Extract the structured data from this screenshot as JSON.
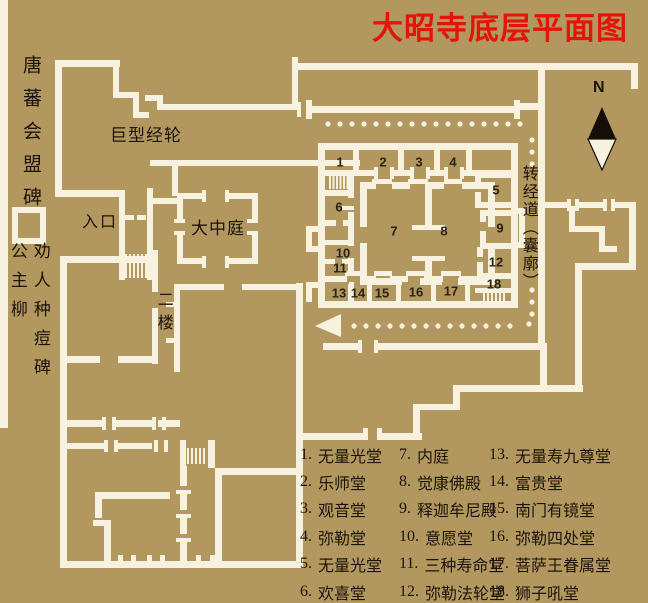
{
  "title": "大昭寺底层平面图",
  "map": {
    "labels": {
      "monument_tangbo": "唐蕃会盟碑",
      "princess_willow": "公主柳",
      "vaccination_monument": "劝人种痘碑",
      "giant_prayer_wheel": "巨型经轮",
      "entrance": "入口",
      "grand_courtyard": "大中庭",
      "second_floor": "二楼",
      "prayer_circuit": "转经道（囊廓）",
      "compass_north": "N"
    },
    "rooms": [
      {
        "id": "1",
        "name": "无量光堂"
      },
      {
        "id": "2",
        "name": "乐师堂"
      },
      {
        "id": "3",
        "name": "观音堂"
      },
      {
        "id": "4",
        "name": "弥勒堂"
      },
      {
        "id": "5",
        "name": "无量光堂"
      },
      {
        "id": "6",
        "name": "欢喜堂"
      },
      {
        "id": "7",
        "name": "内庭"
      },
      {
        "id": "8",
        "name": "觉康佛殿"
      },
      {
        "id": "9",
        "name": "释迦牟尼殿"
      },
      {
        "id": "10",
        "name": "意愿堂"
      },
      {
        "id": "11",
        "name": "三种寿命堂"
      },
      {
        "id": "12",
        "name": "弥勒法轮堂"
      },
      {
        "id": "13",
        "name": "无量寿九尊堂"
      },
      {
        "id": "14",
        "name": "富贵堂"
      },
      {
        "id": "15",
        "name": "南门有镜堂"
      },
      {
        "id": "16",
        "name": "弥勒四处堂"
      },
      {
        "id": "17",
        "name": "菩萨王眷属堂"
      },
      {
        "id": "18",
        "name": "狮子吼堂"
      }
    ]
  },
  "colors": {
    "background": "#b2985f",
    "wall": "#f7f1df",
    "title_red": "#e51408",
    "text_black": "#1c1309"
  }
}
